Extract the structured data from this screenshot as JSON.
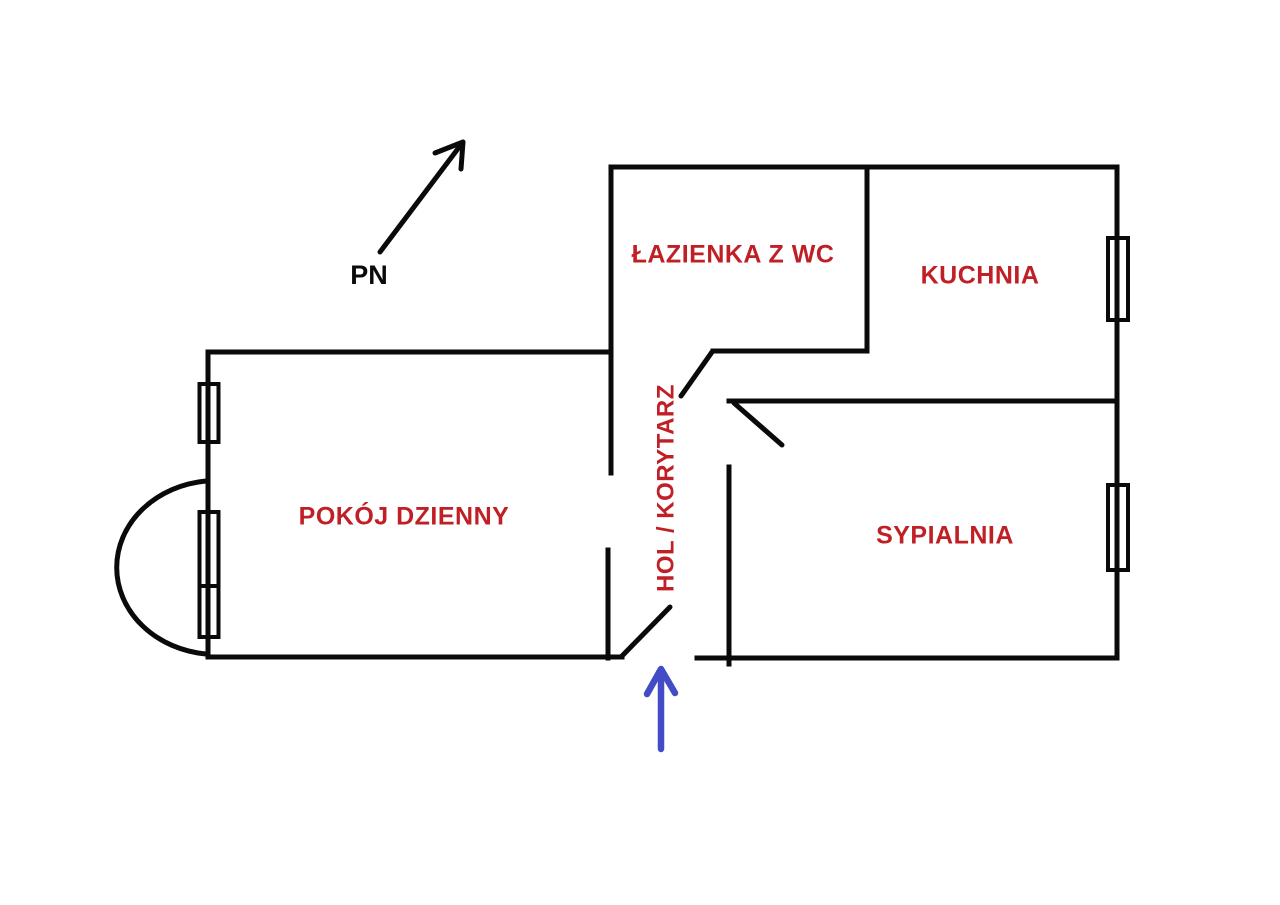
{
  "north_indicator": {
    "label": "PN"
  },
  "rooms": [
    {
      "id": "bathroom",
      "label": "ŁAZIENKA Z WC"
    },
    {
      "id": "kitchen",
      "label": "KUCHNIA"
    },
    {
      "id": "living_room",
      "label": "POKÓJ DZIENNY"
    },
    {
      "id": "hall",
      "label": "HOL / KORYTARZ"
    },
    {
      "id": "bedroom",
      "label": "SYPIALNIA"
    }
  ],
  "colors": {
    "room_label": "#c01f26",
    "walls": "#0a0a0a",
    "entrance_arrow": "#444bc7",
    "background": "#ffffff"
  },
  "icons": {
    "north_arrow": "diagonal-arrow-up-right",
    "entrance_arrow": "arrow-up",
    "window_symbol": "double-rect-on-wall",
    "door_symbol": "diagonal-door-swing",
    "balcony_symbol": "semicircle-arc"
  }
}
